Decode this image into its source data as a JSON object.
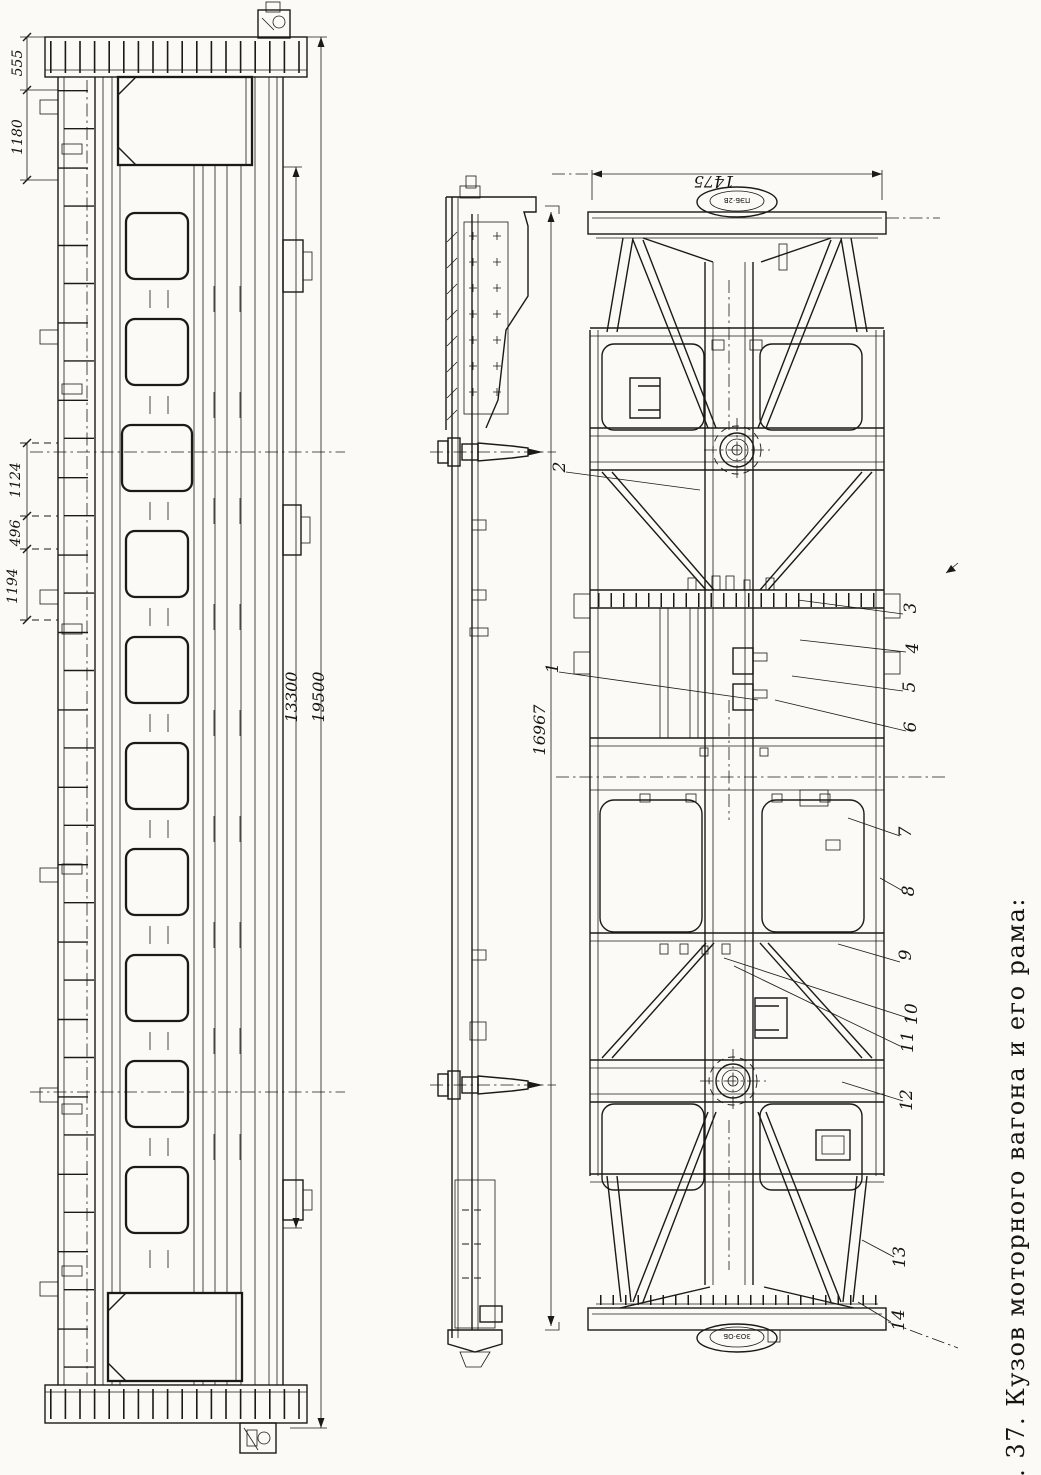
{
  "figure": {
    "caption": "Рис. 37. Кузов моторного вагона и его рама:"
  },
  "dimensions": {
    "end_overhang": "555",
    "end_bay": "1180",
    "bay_a": "1124",
    "bay_b": "496",
    "bay_c": "1194",
    "body_side_length": "13300",
    "overall_length": "19500",
    "frame_length": "16967",
    "end_beam_width": "1475"
  },
  "stamps": {
    "top_coupler_oval": "ПЭБ·2В",
    "bottom_coupler_oval": "ЗОЭ·ОБ"
  },
  "callouts": {
    "c1": "1",
    "c2": "2",
    "c3": "3",
    "c4": "4",
    "c5": "5",
    "c6": "6",
    "c7": "7",
    "c8": "8",
    "c9": "9",
    "c10": "10",
    "c11": "11",
    "c12": "12",
    "c13": "13",
    "c14": "14"
  }
}
